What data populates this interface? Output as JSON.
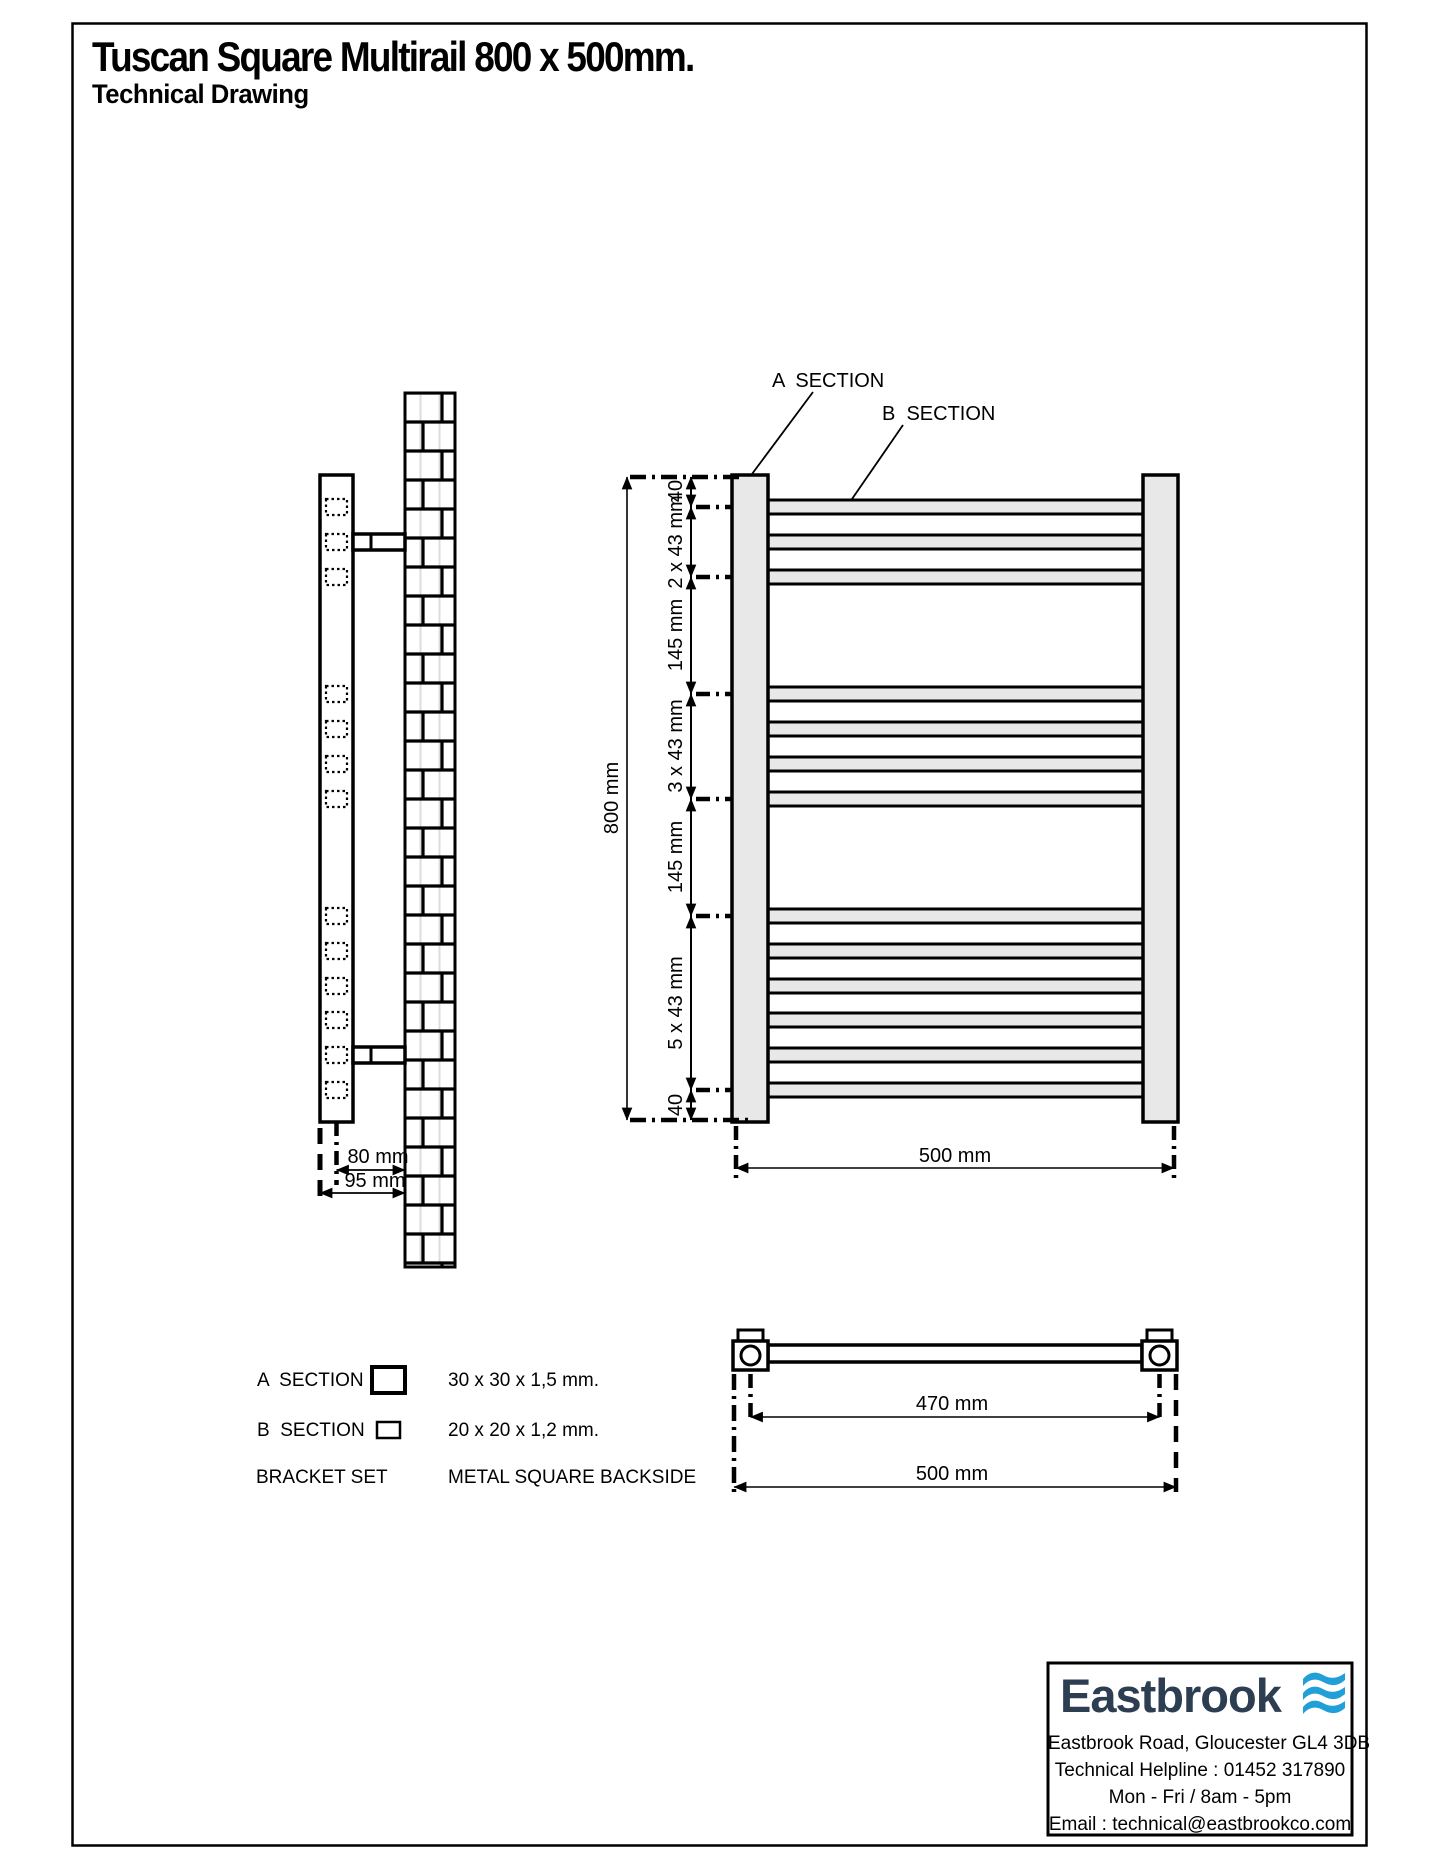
{
  "page": {
    "title": "Tuscan Square Multirail 800 x 500mm.",
    "subtitle": "Technical Drawing"
  },
  "front_view": {
    "section_a": "A  SECTION",
    "section_b": "B  SECTION",
    "dim_total_height": "800 mm",
    "dim_top_offset": "40",
    "dim_group1": "2 x 43 mm",
    "dim_gap1": "145 mm",
    "dim_group2": "3 x 43 mm",
    "dim_gap2": "145 mm",
    "dim_group3": "5 x 43 mm",
    "dim_bottom_offset": "40",
    "dim_total_width": "500 mm"
  },
  "side_view": {
    "dim_center_to_wall": "80 mm",
    "dim_overall_depth": "95 mm"
  },
  "top_view": {
    "dim_fixing_centers": "470 mm",
    "dim_overall_width": "500 mm"
  },
  "legend": {
    "section_a_label": "A  SECTION",
    "section_a_spec": "30 x 30 x 1,5 mm.",
    "section_b_label": "B  SECTION",
    "section_b_spec": "20 x 20 x 1,2 mm.",
    "bracket_label": "BRACKET SET",
    "bracket_spec": "METAL SQUARE BACKSIDE"
  },
  "footer": {
    "brand": "Eastbrook",
    "address": "Eastbrook Road, Gloucester GL4 3DB",
    "helpline": "Technical Helpline : 01452 317890",
    "hours": "Mon - Fri / 8am - 5pm",
    "email": "Email : technical@eastbrookco.com"
  },
  "colors": {
    "brand_navy": "#2d3e52",
    "wave_blue": "#219fd9",
    "rail_grey": "#e8e8e8",
    "line_black": "#000000"
  }
}
